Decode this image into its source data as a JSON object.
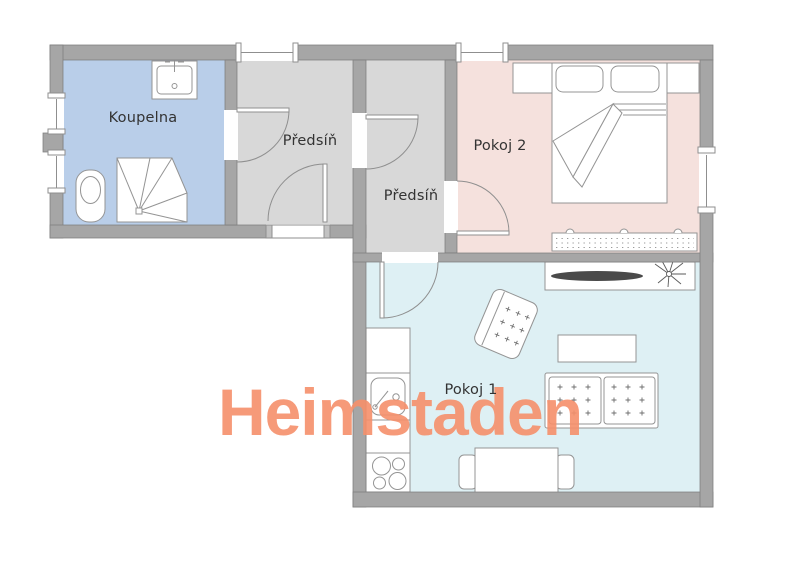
{
  "watermark": {
    "text": "Heimstaden",
    "color": "#f6906b"
  },
  "rooms": [
    {
      "id": "koupelna",
      "label": "Koupelna",
      "fill": "#b9cee9"
    },
    {
      "id": "predsin-1",
      "label": "Předsíň",
      "fill": "#d8d8d8"
    },
    {
      "id": "predsin-2",
      "label": "Předsíň",
      "fill": "#d8d8d8"
    },
    {
      "id": "pokoj-2",
      "label": "Pokoj 2",
      "fill": "#f5e1dd"
    },
    {
      "id": "pokoj-1",
      "label": "Pokoj 1",
      "fill": "#def0f4"
    }
  ],
  "palette": {
    "wall": "#a6a6a6",
    "wall_outline": "#7d7d7d",
    "furniture_outline": "#949494",
    "door_line": "#8f8f8f",
    "tv": "#4a4a4a",
    "label_color": "#333333",
    "background": "#ffffff"
  },
  "furniture": [
    "washbasin",
    "toilet",
    "shower",
    "headboard-shelf",
    "double-bed",
    "pillow",
    "pillow",
    "blanket",
    "radiator",
    "tv-sideboard",
    "tv",
    "plant",
    "armchair",
    "coffee-table",
    "sofa",
    "kitchen-counter",
    "kitchen-sink",
    "stove",
    "dining-table",
    "chair",
    "chair"
  ],
  "doors": {
    "count": 5
  },
  "windows": {
    "count": 5
  }
}
